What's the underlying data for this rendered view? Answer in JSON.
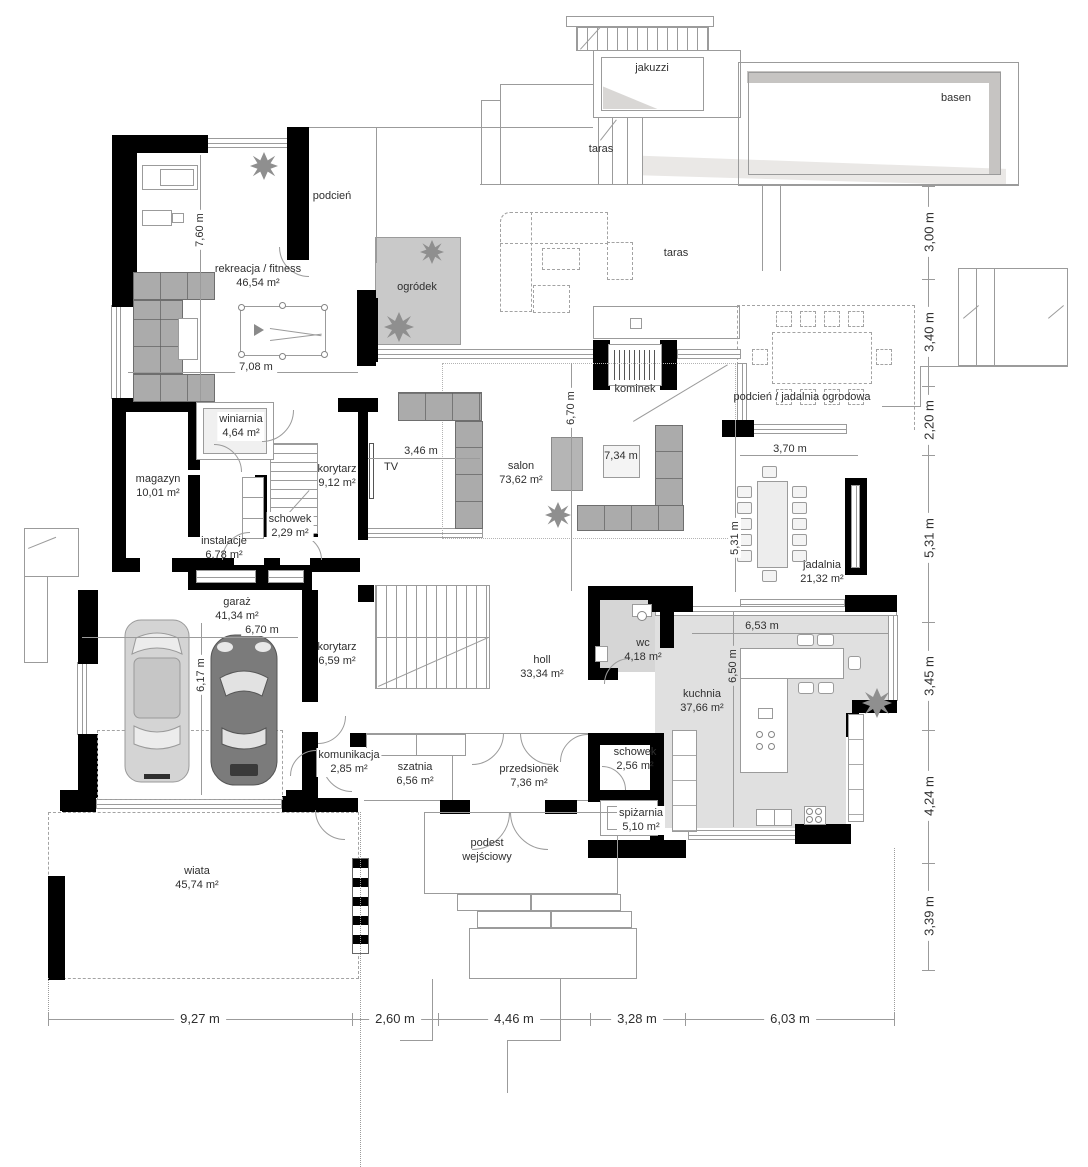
{
  "rooms": {
    "jakuzzi": {
      "name": "jakuzzi"
    },
    "basen": {
      "name": "basen"
    },
    "taras_gorny": {
      "name": "taras"
    },
    "taras": {
      "name": "taras"
    },
    "podcien": {
      "name": "podcień"
    },
    "fitness": {
      "name": "rekreacja / fitness",
      "area": "46,54 m²"
    },
    "ogrodek": {
      "name": "ogródek"
    },
    "kominek": {
      "name": "kominek"
    },
    "jadalnia_ogrodowa": {
      "name": "podcień / jadalnia ogrodowa"
    },
    "winiarnia": {
      "name": "winiarnia",
      "area": "4,64 m²"
    },
    "magazyn": {
      "name": "magazyn",
      "area": "10,01 m²"
    },
    "korytarz1": {
      "name": "korytarz",
      "area": "9,12 m²"
    },
    "tv": {
      "name": "TV"
    },
    "salon": {
      "name": "salon",
      "area": "73,62 m²"
    },
    "schowek1": {
      "name": "schowek",
      "area": "2,29 m²"
    },
    "instalacje": {
      "name": "instalacje",
      "area": "6,78 m²"
    },
    "jadalnia": {
      "name": "jadalnia",
      "area": "21,32 m²"
    },
    "garaz": {
      "name": "garaż",
      "area": "41,34 m²"
    },
    "korytarz2": {
      "name": "korytarz",
      "area": "6,59 m²"
    },
    "holl": {
      "name": "holl",
      "area": "33,34 m²"
    },
    "wc": {
      "name": "wc",
      "area": "4,18 m²"
    },
    "kuchnia": {
      "name": "kuchnia",
      "area": "37,66 m²"
    },
    "komunikacja": {
      "name": "komunikacja",
      "area": "2,85 m²"
    },
    "szatnia": {
      "name": "szatnia",
      "area": "6,56 m²"
    },
    "przedsionek": {
      "name": "przedsionek",
      "area": "7,36 m²"
    },
    "schowek2": {
      "name": "schowek",
      "area": "2,56 m²"
    },
    "spizarnia": {
      "name": "spiżarnia",
      "area": "5,10 m²"
    },
    "podest": {
      "name": "podest wejściowy"
    },
    "wiata": {
      "name": "wiata",
      "area": "45,74 m²"
    }
  },
  "dimensions": {
    "right": [
      "3,00 m",
      "3,40 m",
      "2,20 m",
      "5,31 m",
      "3,45 m",
      "4,24 m",
      "3,39 m"
    ],
    "bottom": [
      "9,27 m",
      "2,60 m",
      "4,46 m",
      "3,28 m",
      "6,03 m"
    ],
    "interior": {
      "fitness_width": "7,08 m",
      "fitness_height": "7,60 m",
      "tv_wall": "3,46 m",
      "salon_height": "6,70 m",
      "salon_width": "7,34 m",
      "jadalnia_width": "3,70 m",
      "jadalnia_height": "5,31 m",
      "garaz_width": "6,70 m",
      "garaz_height": "6,17 m",
      "kuchnia_width": "6,53 m",
      "kuchnia_height": "6,50 m"
    }
  },
  "icons": {
    "plant": "spiky-burst-star"
  }
}
